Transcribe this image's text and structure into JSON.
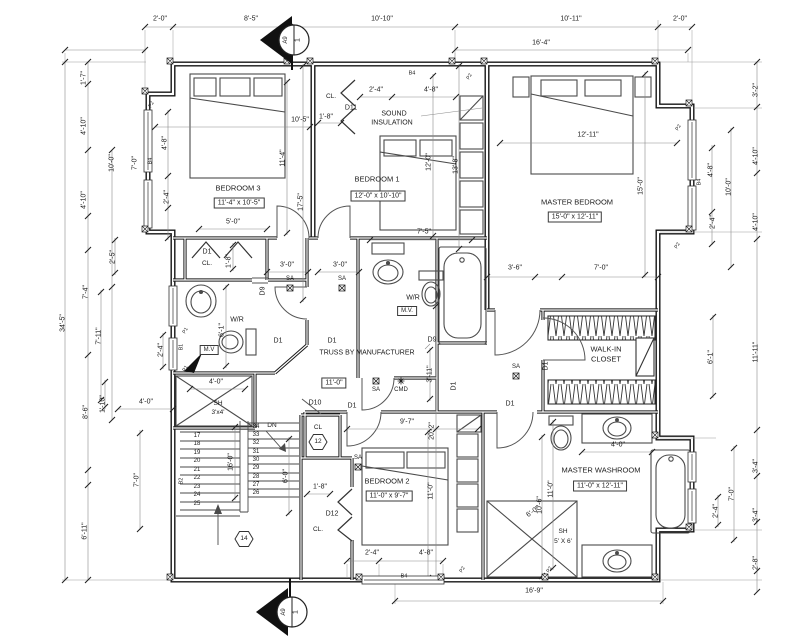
{
  "drawing": {
    "kind": "architectural floor plan",
    "section_marker": {
      "detail_number": "1",
      "sheet": "A9"
    },
    "colors": {
      "line": "#161616",
      "dim_line": "#8a8a8a",
      "text": "#1c1c1c",
      "bg": "#ffffff"
    }
  },
  "rooms": [
    {
      "name": "BEDROOM 3",
      "size": "11'-4\" x 10'-5\""
    },
    {
      "name": "BEDROOM 1",
      "size": "12'-0\" x 10'-10\""
    },
    {
      "name": "MASTER BEDROOM",
      "size": "15'-0\" x 12'-11\""
    },
    {
      "name": "BEDROOM 2",
      "size": "11'-0\" x 9'-7\""
    },
    {
      "name": "MASTER WASHROOM",
      "size": "11'-0\" x 12'-11\""
    },
    {
      "name": "WALK-IN CLOSET"
    },
    {
      "name": "W/R"
    },
    {
      "name": "W/R"
    }
  ],
  "notes": [
    "SOUND INSULATION",
    "TRUSS BY MANUFACTURER"
  ],
  "markers": {
    "hex_tags": [
      "12",
      "14"
    ],
    "stair_direction": "DN"
  },
  "labels": [
    {
      "t": "2'-0\"",
      "x": 160,
      "y": 19
    },
    {
      "t": "8'-5\"",
      "x": 251,
      "y": 19
    },
    {
      "t": "10'-10\"",
      "x": 382,
      "y": 19
    },
    {
      "t": "10'-11\"",
      "x": 571,
      "y": 19
    },
    {
      "t": "2'-0\"",
      "x": 680,
      "y": 19
    },
    {
      "t": "16'-4\"",
      "x": 541,
      "y": 43
    },
    {
      "t": "1'-7\"",
      "x": 84,
      "y": 78,
      "r": -90
    },
    {
      "t": "4'-10\"",
      "x": 84,
      "y": 126,
      "r": -90
    },
    {
      "t": "4'-10\"",
      "x": 84,
      "y": 200,
      "r": -90
    },
    {
      "t": "34'-5\"",
      "x": 63,
      "y": 323,
      "r": -90
    },
    {
      "t": "10'-0\"",
      "x": 112,
      "y": 163,
      "r": -90
    },
    {
      "t": "7'-0\"",
      "x": 135,
      "y": 163,
      "r": -90
    },
    {
      "t": "4'-8\"",
      "x": 165,
      "y": 143,
      "r": -90
    },
    {
      "t": "2'-4\"",
      "x": 167,
      "y": 197,
      "r": -90
    },
    {
      "t": "B4",
      "x": 151,
      "y": 161,
      "r": -90,
      "fs": 5.5
    },
    {
      "t": "2'-5\"",
      "x": 113,
      "y": 257,
      "r": -90
    },
    {
      "t": "7'-4\"",
      "x": 86,
      "y": 292,
      "r": -90
    },
    {
      "t": "7'-11\"",
      "x": 99,
      "y": 336,
      "r": -90
    },
    {
      "t": "2'-4\"",
      "x": 161,
      "y": 350,
      "r": -90
    },
    {
      "t": "8'-6\"",
      "x": 86,
      "y": 412,
      "r": -90
    },
    {
      "t": "1'-10\"",
      "x": 103,
      "y": 404,
      "r": -90
    },
    {
      "t": "4'-0\"",
      "x": 146,
      "y": 402
    },
    {
      "t": "7'-0\"",
      "x": 137,
      "y": 480,
      "r": -90
    },
    {
      "t": "6'-11\"",
      "x": 85,
      "y": 531,
      "r": -90
    },
    {
      "t": "3'-2\"",
      "x": 756,
      "y": 90,
      "r": -90
    },
    {
      "t": "4'-10\"",
      "x": 756,
      "y": 156,
      "r": -90
    },
    {
      "t": "4'-10\"",
      "x": 756,
      "y": 222,
      "r": -90
    },
    {
      "t": "11'-11\"",
      "x": 756,
      "y": 352,
      "r": -90
    },
    {
      "t": "3'-4\"",
      "x": 756,
      "y": 466,
      "r": -90
    },
    {
      "t": "3'-4\"",
      "x": 756,
      "y": 515,
      "r": -90
    },
    {
      "t": "2'-8\"",
      "x": 756,
      "y": 563,
      "r": -90
    },
    {
      "t": "4'-8\"",
      "x": 711,
      "y": 170,
      "r": -90
    },
    {
      "t": "2'-4\"",
      "x": 713,
      "y": 222,
      "r": -90
    },
    {
      "t": "10'-0\"",
      "x": 729,
      "y": 187,
      "r": -90
    },
    {
      "t": "B4",
      "x": 700,
      "y": 182,
      "r": -90,
      "fs": 5.5
    },
    {
      "t": "6'-1\"",
      "x": 711,
      "y": 357,
      "r": -90
    },
    {
      "t": "7'-0\"",
      "x": 732,
      "y": 494,
      "r": -90
    },
    {
      "t": "2'-4\"",
      "x": 716,
      "y": 511,
      "r": -90
    },
    {
      "t": "16'-9\"",
      "x": 534,
      "y": 591
    },
    {
      "t": "2'-4\"",
      "x": 372,
      "y": 553
    },
    {
      "t": "4'-8\"",
      "x": 426,
      "y": 553
    },
    {
      "t": "B4",
      "x": 404,
      "y": 577,
      "fs": 5.5
    },
    {
      "t": "BEDROOM 3",
      "x": 238,
      "y": 188,
      "fs": 7.5,
      "n": "room-label-bedroom-3"
    },
    {
      "t": "11'-4\" x 10'-5\"",
      "x": 239,
      "y": 203,
      "b": 1,
      "n": "room-size-bedroom-3"
    },
    {
      "t": "10'-5\"",
      "x": 300,
      "y": 120
    },
    {
      "t": "11'-4\"",
      "x": 283,
      "y": 158,
      "r": -90
    },
    {
      "t": "17'-5\"",
      "x": 301,
      "y": 202,
      "r": -90
    },
    {
      "t": "5'-0\"",
      "x": 233,
      "y": 222
    },
    {
      "t": "D1",
      "x": 207,
      "y": 252
    },
    {
      "t": "CL.",
      "x": 207,
      "y": 264,
      "fs": 6.5
    },
    {
      "t": "1'-8\"",
      "x": 229,
      "y": 261,
      "r": -90
    },
    {
      "t": "3'-0\"",
      "x": 287,
      "y": 265
    },
    {
      "t": "3'-0\"",
      "x": 340,
      "y": 265
    },
    {
      "t": "SA",
      "x": 290,
      "y": 279,
      "fs": 6
    },
    {
      "t": "SA",
      "x": 342,
      "y": 279,
      "fs": 6
    },
    {
      "t": "CL.",
      "x": 331,
      "y": 97,
      "fs": 6.5
    },
    {
      "t": "D11",
      "x": 351,
      "y": 108
    },
    {
      "t": "1'-8\"",
      "x": 326,
      "y": 117
    },
    {
      "t": "2'-4\"",
      "x": 376,
      "y": 90
    },
    {
      "t": "4'-8\"",
      "x": 431,
      "y": 90
    },
    {
      "t": "SOUND",
      "x": 394,
      "y": 114,
      "n": "note-sound-insulation"
    },
    {
      "t": "INSULATION",
      "x": 392,
      "y": 123
    },
    {
      "t": "BEDROOM 1",
      "x": 377,
      "y": 179,
      "fs": 7.5,
      "n": "room-label-bedroom-1"
    },
    {
      "t": "12'-0\" x 10'-10\"",
      "x": 378,
      "y": 196,
      "b": 1,
      "n": "room-size-bedroom-1"
    },
    {
      "t": "12'-0\"",
      "x": 429,
      "y": 162,
      "r": -90
    },
    {
      "t": "13'-8\"",
      "x": 456,
      "y": 165,
      "r": -90
    },
    {
      "t": "7'-5\"",
      "x": 424,
      "y": 232
    },
    {
      "t": "B4",
      "x": 412,
      "y": 74,
      "fs": 5.5
    },
    {
      "t": "MASTER BEDROOM",
      "x": 577,
      "y": 202,
      "fs": 7.5,
      "n": "room-label-master-bedroom"
    },
    {
      "t": "15'-0\" x 12'-11\"",
      "x": 575,
      "y": 217,
      "b": 1,
      "n": "room-size-master-bedroom"
    },
    {
      "t": "12'-11\"",
      "x": 588,
      "y": 135
    },
    {
      "t": "15'-0\"",
      "x": 641,
      "y": 186,
      "r": -90
    },
    {
      "t": "3'-6\"",
      "x": 515,
      "y": 268
    },
    {
      "t": "7'-0\"",
      "x": 601,
      "y": 268
    },
    {
      "t": "W/R",
      "x": 237,
      "y": 320,
      "n": "room-label-wr-left"
    },
    {
      "t": "6'-1\"",
      "x": 222,
      "y": 330,
      "r": -90
    },
    {
      "t": "M.V",
      "x": 209,
      "y": 350,
      "b": 1,
      "fs": 6
    },
    {
      "t": "4'-0\"",
      "x": 216,
      "y": 382
    },
    {
      "t": "D9",
      "x": 263,
      "y": 291,
      "r": -90
    },
    {
      "t": "D1",
      "x": 278,
      "y": 341
    },
    {
      "t": "D1",
      "x": 332,
      "y": 341
    },
    {
      "t": "W/R",
      "x": 413,
      "y": 298,
      "n": "room-label-wr-center"
    },
    {
      "t": "M.V.",
      "x": 407,
      "y": 311,
      "b": 1,
      "fs": 6
    },
    {
      "t": "D9",
      "x": 432,
      "y": 340
    },
    {
      "t": "TRUSS BY MANUFACTURER",
      "x": 367,
      "y": 353,
      "n": "note-truss"
    },
    {
      "t": "WALK-IN",
      "x": 606,
      "y": 349,
      "fs": 7.5,
      "n": "room-label-walk-in-closet"
    },
    {
      "t": "CLOSET",
      "x": 606,
      "y": 359,
      "fs": 7.5
    },
    {
      "t": "D1",
      "x": 546,
      "y": 366,
      "r": -90
    },
    {
      "t": "SA",
      "x": 516,
      "y": 367,
      "fs": 6
    },
    {
      "t": "D1",
      "x": 454,
      "y": 386,
      "r": -90
    },
    {
      "t": "D1",
      "x": 510,
      "y": 404
    },
    {
      "t": "D1",
      "x": 352,
      "y": 406
    },
    {
      "t": "11'-0\"",
      "x": 334,
      "y": 383,
      "b": 1
    },
    {
      "t": "SA",
      "x": 376,
      "y": 390,
      "fs": 6
    },
    {
      "t": "CMD",
      "x": 401,
      "y": 390,
      "fs": 6
    },
    {
      "t": "3'-11\"",
      "x": 430,
      "y": 374,
      "r": -90
    },
    {
      "t": "D10",
      "x": 315,
      "y": 403
    },
    {
      "t": "CL",
      "x": 318,
      "y": 428,
      "fs": 6.5
    },
    {
      "t": "12",
      "x": 318,
      "y": 442,
      "fs": 6.5
    },
    {
      "t": "9'-7\"",
      "x": 407,
      "y": 422
    },
    {
      "t": "20'-2\"",
      "x": 432,
      "y": 431,
      "r": -90
    },
    {
      "t": "SA",
      "x": 358,
      "y": 458,
      "fs": 6
    },
    {
      "t": "BEDROOM 2",
      "x": 387,
      "y": 481,
      "fs": 7.5,
      "n": "room-label-bedroom-2"
    },
    {
      "t": "11'-0\" x 9'-7\"",
      "x": 389,
      "y": 496,
      "b": 1,
      "n": "room-size-bedroom-2"
    },
    {
      "t": "11'-0\"",
      "x": 431,
      "y": 491,
      "r": -90
    },
    {
      "t": "1'-8\"",
      "x": 320,
      "y": 487
    },
    {
      "t": "D12",
      "x": 332,
      "y": 514
    },
    {
      "t": "CL.",
      "x": 318,
      "y": 530,
      "fs": 6.5
    },
    {
      "t": "6'-0\"",
      "x": 286,
      "y": 476,
      "r": -90
    },
    {
      "t": "16'-0\"",
      "x": 231,
      "y": 462,
      "r": -90
    },
    {
      "t": "B2",
      "x": 182,
      "y": 481,
      "r": -90,
      "fs": 5.5
    },
    {
      "t": "DN",
      "x": 272,
      "y": 426,
      "fs": 6.5
    },
    {
      "t": "17",
      "x": 197,
      "y": 436,
      "fs": 6
    },
    {
      "t": "18",
      "x": 197,
      "y": 444,
      "fs": 6
    },
    {
      "t": "19",
      "x": 197,
      "y": 453,
      "fs": 6
    },
    {
      "t": "20",
      "x": 197,
      "y": 461,
      "fs": 6
    },
    {
      "t": "21",
      "x": 197,
      "y": 470,
      "fs": 6
    },
    {
      "t": "22",
      "x": 197,
      "y": 478,
      "fs": 6
    },
    {
      "t": "23",
      "x": 197,
      "y": 487,
      "fs": 6
    },
    {
      "t": "24",
      "x": 197,
      "y": 495,
      "fs": 6
    },
    {
      "t": "25",
      "x": 197,
      "y": 504,
      "fs": 6
    },
    {
      "t": "34",
      "x": 256,
      "y": 427,
      "fs": 6
    },
    {
      "t": "33",
      "x": 256,
      "y": 435,
      "fs": 6
    },
    {
      "t": "32",
      "x": 256,
      "y": 443,
      "fs": 6
    },
    {
      "t": "31",
      "x": 256,
      "y": 452,
      "fs": 6
    },
    {
      "t": "30",
      "x": 256,
      "y": 460,
      "fs": 6
    },
    {
      "t": "29",
      "x": 256,
      "y": 468,
      "fs": 6
    },
    {
      "t": "28",
      "x": 256,
      "y": 477,
      "fs": 6
    },
    {
      "t": "27",
      "x": 256,
      "y": 485,
      "fs": 6
    },
    {
      "t": "26",
      "x": 256,
      "y": 493,
      "fs": 6
    },
    {
      "t": "14",
      "x": 244,
      "y": 539,
      "fs": 6.5
    },
    {
      "t": "SH",
      "x": 218,
      "y": 404,
      "fs": 6.5
    },
    {
      "t": "3'x4'",
      "x": 218,
      "y": 413,
      "fs": 6.5
    },
    {
      "t": "MASTER WASHROOM",
      "x": 601,
      "y": 470,
      "fs": 7.5,
      "n": "room-label-master-washroom"
    },
    {
      "t": "11'-0\" x 12'-11\"",
      "x": 600,
      "y": 486,
      "b": 1,
      "n": "room-size-master-washroom"
    },
    {
      "t": "4'-0\"",
      "x": 618,
      "y": 445
    },
    {
      "t": "6'-0\"",
      "x": 533,
      "y": 512,
      "r": -35
    },
    {
      "t": "SH",
      "x": 563,
      "y": 532,
      "fs": 6.5
    },
    {
      "t": "5' X 6'",
      "x": 563,
      "y": 542,
      "fs": 6.5
    },
    {
      "t": "11'-0\"",
      "x": 551,
      "y": 489,
      "r": -90
    },
    {
      "t": "10'-6\"",
      "x": 540,
      "y": 505,
      "r": -90
    },
    {
      "t": "1",
      "x": 298,
      "y": 40,
      "r": -90,
      "n": "section-marker-number-top"
    },
    {
      "t": "A9",
      "x": 286,
      "y": 40,
      "r": -90,
      "fs": 6,
      "n": "section-marker-sheet-top"
    },
    {
      "t": "1",
      "x": 296,
      "y": 612,
      "r": -90,
      "n": "section-marker-number-bottom"
    },
    {
      "t": "A9",
      "x": 284,
      "y": 612,
      "r": -90,
      "fs": 6,
      "n": "section-marker-sheet-bottom"
    },
    {
      "t": "P2",
      "x": 470,
      "y": 77,
      "r": -60,
      "fs": 5
    },
    {
      "t": "P2",
      "x": 679,
      "y": 128,
      "r": -60,
      "fs": 5
    },
    {
      "t": "P2",
      "x": 678,
      "y": 246,
      "r": -60,
      "fs": 5
    },
    {
      "t": "P2",
      "x": 152,
      "y": 105,
      "r": -60,
      "fs": 5
    },
    {
      "t": "P2",
      "x": 463,
      "y": 570,
      "r": -60,
      "fs": 5
    },
    {
      "t": "P2",
      "x": 550,
      "y": 570,
      "r": -60,
      "fs": 5
    },
    {
      "t": "P1",
      "x": 186,
      "y": 331,
      "r": -60,
      "fs": 5
    },
    {
      "t": "P1",
      "x": 186,
      "y": 369,
      "r": -60,
      "fs": 5
    },
    {
      "t": "B1",
      "x": 182,
      "y": 347,
      "r": -90,
      "fs": 5
    }
  ]
}
